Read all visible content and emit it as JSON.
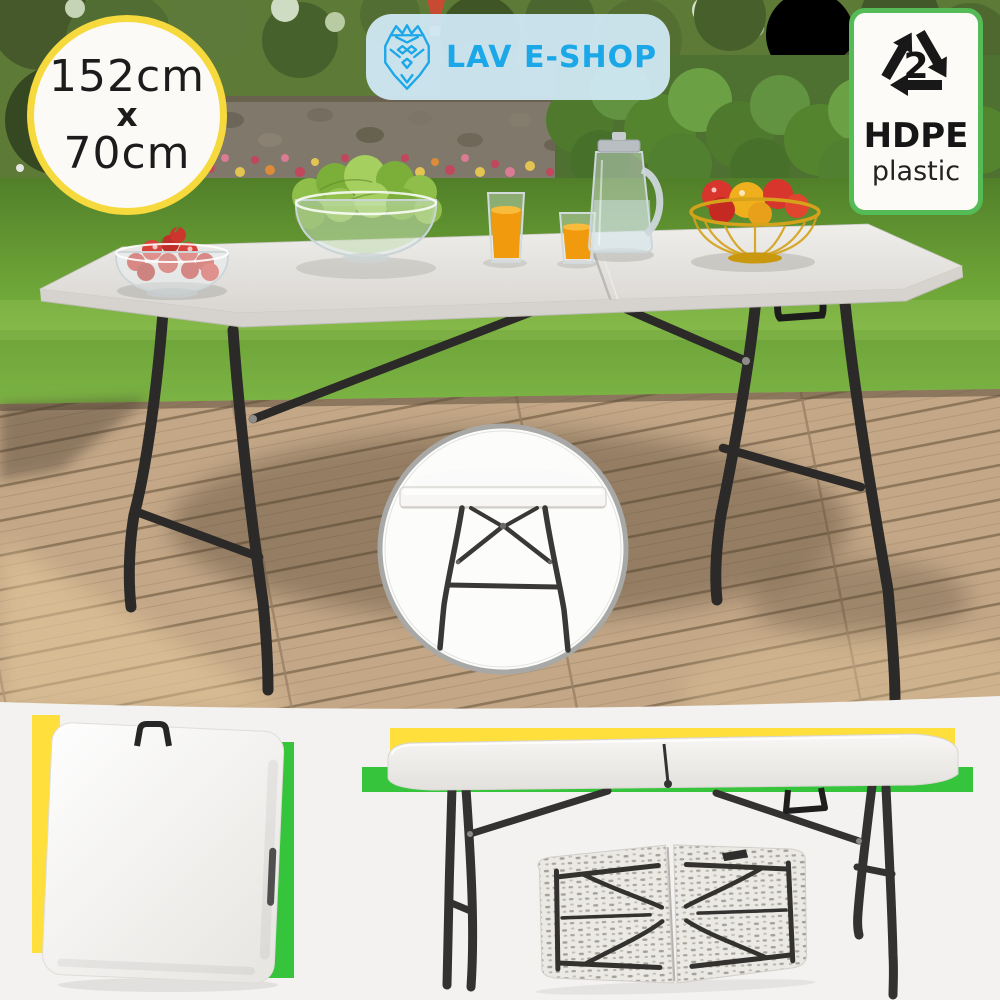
{
  "badges": {
    "dimensions": {
      "width": "152cm",
      "separator": "x",
      "depth": "70cm"
    },
    "material": {
      "resin_code": "2",
      "material_name": "HDPE",
      "material_sub": "plastic"
    }
  },
  "logo": {
    "shop_name": "LAV E-SHOP"
  },
  "colors": {
    "accent_yellow": "#FFDF3C",
    "accent_green": "#35C43B",
    "brand_blue": "#1BA7E8",
    "logo_pill_bg": "#D0E8F4",
    "badge_border_yellow": "#F6D93D",
    "hdpe_border_green": "#55BB57"
  },
  "icons": {
    "logo_icon": "lion-line-icon",
    "material_icon": "recycling-triangle-icon",
    "detail_icon": "table-side-view-inset"
  }
}
